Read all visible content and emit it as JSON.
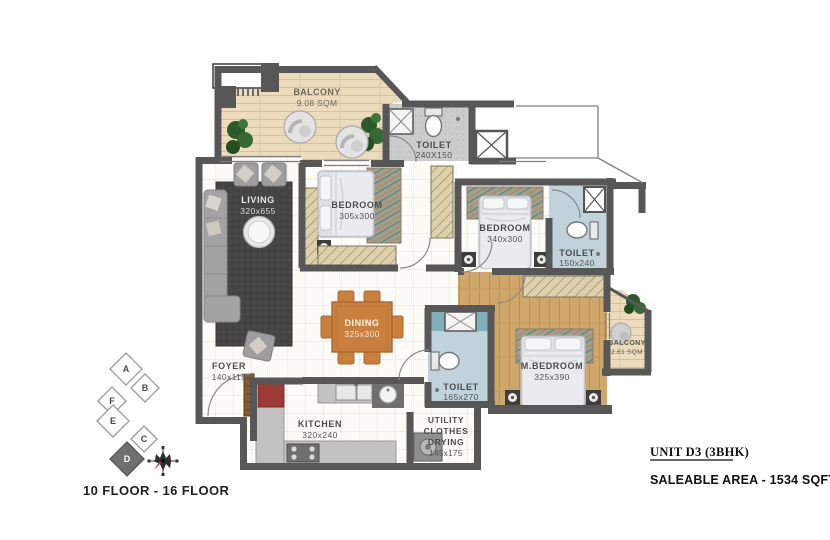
{
  "rooms": {
    "balcony1": {
      "label": "BALCONY",
      "dims": "9.08 SQM"
    },
    "toilet1": {
      "label": "TOILET",
      "dims": "240X150"
    },
    "living": {
      "label": "LIVING",
      "dims": "320x655"
    },
    "bedroom1": {
      "label": "BEDROOM",
      "dims": "305x300"
    },
    "bedroom2": {
      "label": "BEDROOM",
      "dims": "340x300"
    },
    "toilet2": {
      "label": "TOILET",
      "dims": "150x240"
    },
    "mbedroom": {
      "label": "M.BEDROOM",
      "dims": "325x390"
    },
    "balcony2": {
      "label": "BALCONY",
      "dims": "2.61 SQM"
    },
    "dining": {
      "label": "DINING",
      "dims": "325x300"
    },
    "toilet3": {
      "label": "TOILET",
      "dims": "165x270"
    },
    "foyer": {
      "label": "FOYER",
      "dims": "140x115"
    },
    "kitchen": {
      "label": "KITCHEN",
      "dims": "320x240"
    },
    "utility": {
      "label": "UTILITY",
      "line2": "CLOTHES",
      "line3": "DRYING",
      "dims": "145x175"
    }
  },
  "keyplan": {
    "blocks": [
      "A",
      "B",
      "F",
      "E",
      "C",
      "D"
    ],
    "highlighted_block": "D",
    "floor_range": "10 FLOOR - 16 FLOOR"
  },
  "info": {
    "unit_title": "UNIT D3 (3BHK)",
    "saleable_area": "SALEABLE AREA - 1534 SQFT"
  },
  "colors": {
    "wall": "#575757",
    "balcony_wood": "#ecdcbc",
    "master_wood": "#d0a76b",
    "toilet_blue": "#c0d2da",
    "toilet_gray": "#cccccc",
    "teal_accent": "#2f8c91",
    "dining_wood": "#c9803e",
    "fridge_red": "#9c3b34",
    "compass_needle_red": "#c0392b"
  }
}
